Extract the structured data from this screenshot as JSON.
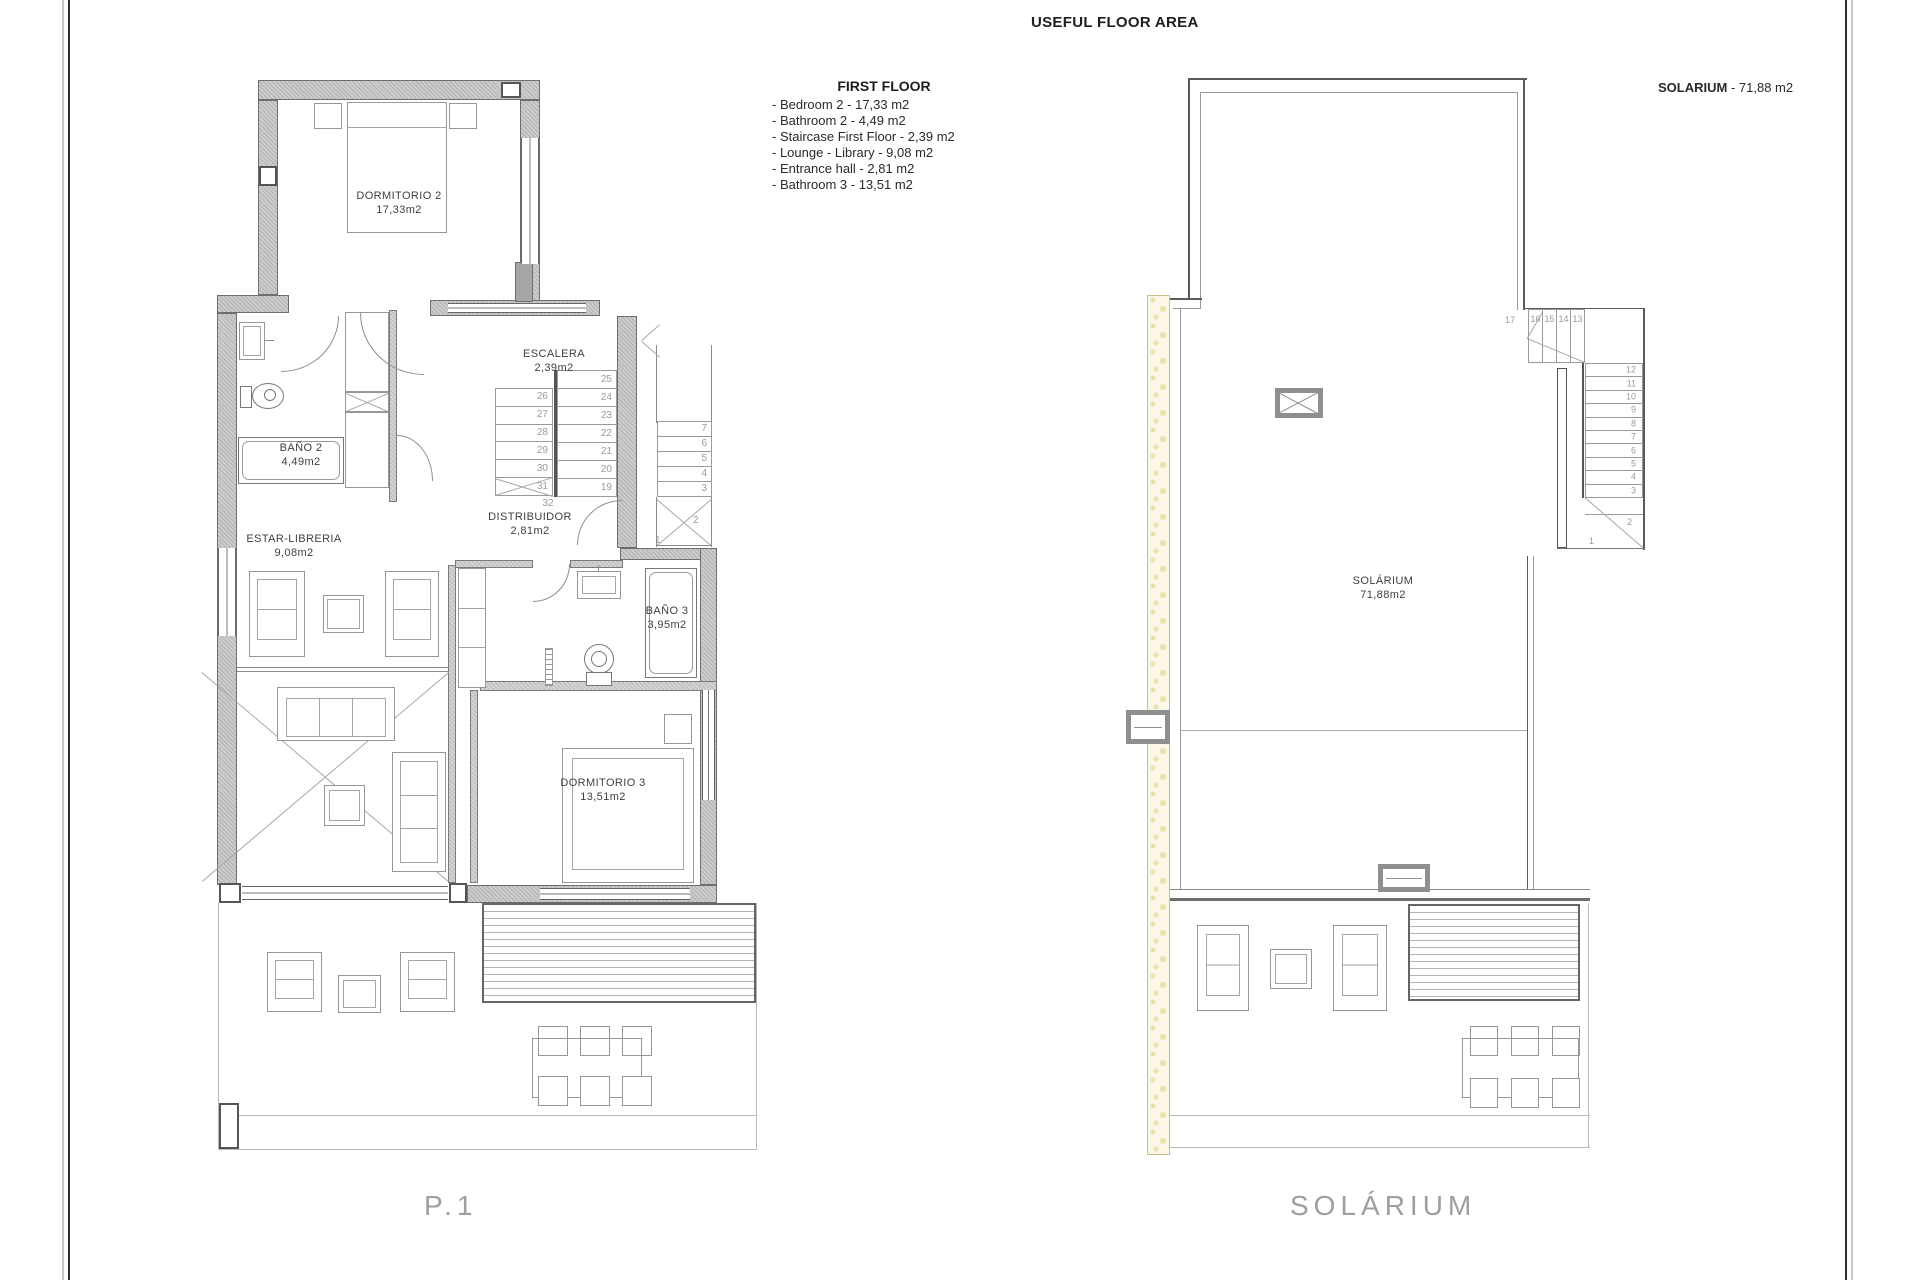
{
  "header": {
    "title": "USEFUL FLOOR AREA",
    "solarium_label": "SOLARIUM",
    "solarium_area": " - 71,88 m2"
  },
  "legend": {
    "title": "FIRST FLOOR",
    "items": [
      "- Bedroom 2 - 17,33 m2",
      "- Bathroom 2 - 4,49 m2",
      "- Staircase First Floor - 2,39 m2",
      "- Lounge - Library - 9,08 m2",
      "- Entrance hall - 2,81 m2",
      "- Bathroom 3 - 13,51 m2"
    ]
  },
  "plan1": {
    "caption": "P.1",
    "dormitorio2": {
      "name": "DORMITORIO 2",
      "area": "17,33m2"
    },
    "bano2": {
      "name": "BAÑO 2",
      "area": "4,49m2"
    },
    "escalera": {
      "name": "ESCALERA",
      "area": "2,39m2"
    },
    "distribuidor": {
      "name": "DISTRIBUIDOR",
      "area": "2,81m2"
    },
    "estar": {
      "name": "ESTAR-LIBRERIA",
      "area": "9,08m2"
    },
    "bano3": {
      "name": "BAÑO 3",
      "area": "3,95m2"
    },
    "dormitorio3": {
      "name": "DORMITORIO 3",
      "area": "13,51m2"
    },
    "stairs": {
      "up_left": [
        "26",
        "27",
        "28",
        "29",
        "30",
        "31"
      ],
      "up_right": [
        "25",
        "24",
        "23",
        "22",
        "21",
        "20",
        "19"
      ],
      "landing": "32",
      "down_upper": [
        "7",
        "6",
        "5",
        "4",
        "3"
      ],
      "down_lower": [
        "2",
        "1"
      ]
    }
  },
  "plan2": {
    "caption": "SOLÁRIUM",
    "solarium": {
      "name": "SOLÁRIUM",
      "area": "71,88m2"
    },
    "stairs": {
      "winder": "17",
      "top_row": [
        "16",
        "15",
        "14",
        "13"
      ],
      "flight": [
        "12",
        "11",
        "10",
        "9",
        "8",
        "7",
        "6",
        "5",
        "4",
        "3"
      ],
      "lower": [
        "2",
        "1"
      ]
    }
  }
}
